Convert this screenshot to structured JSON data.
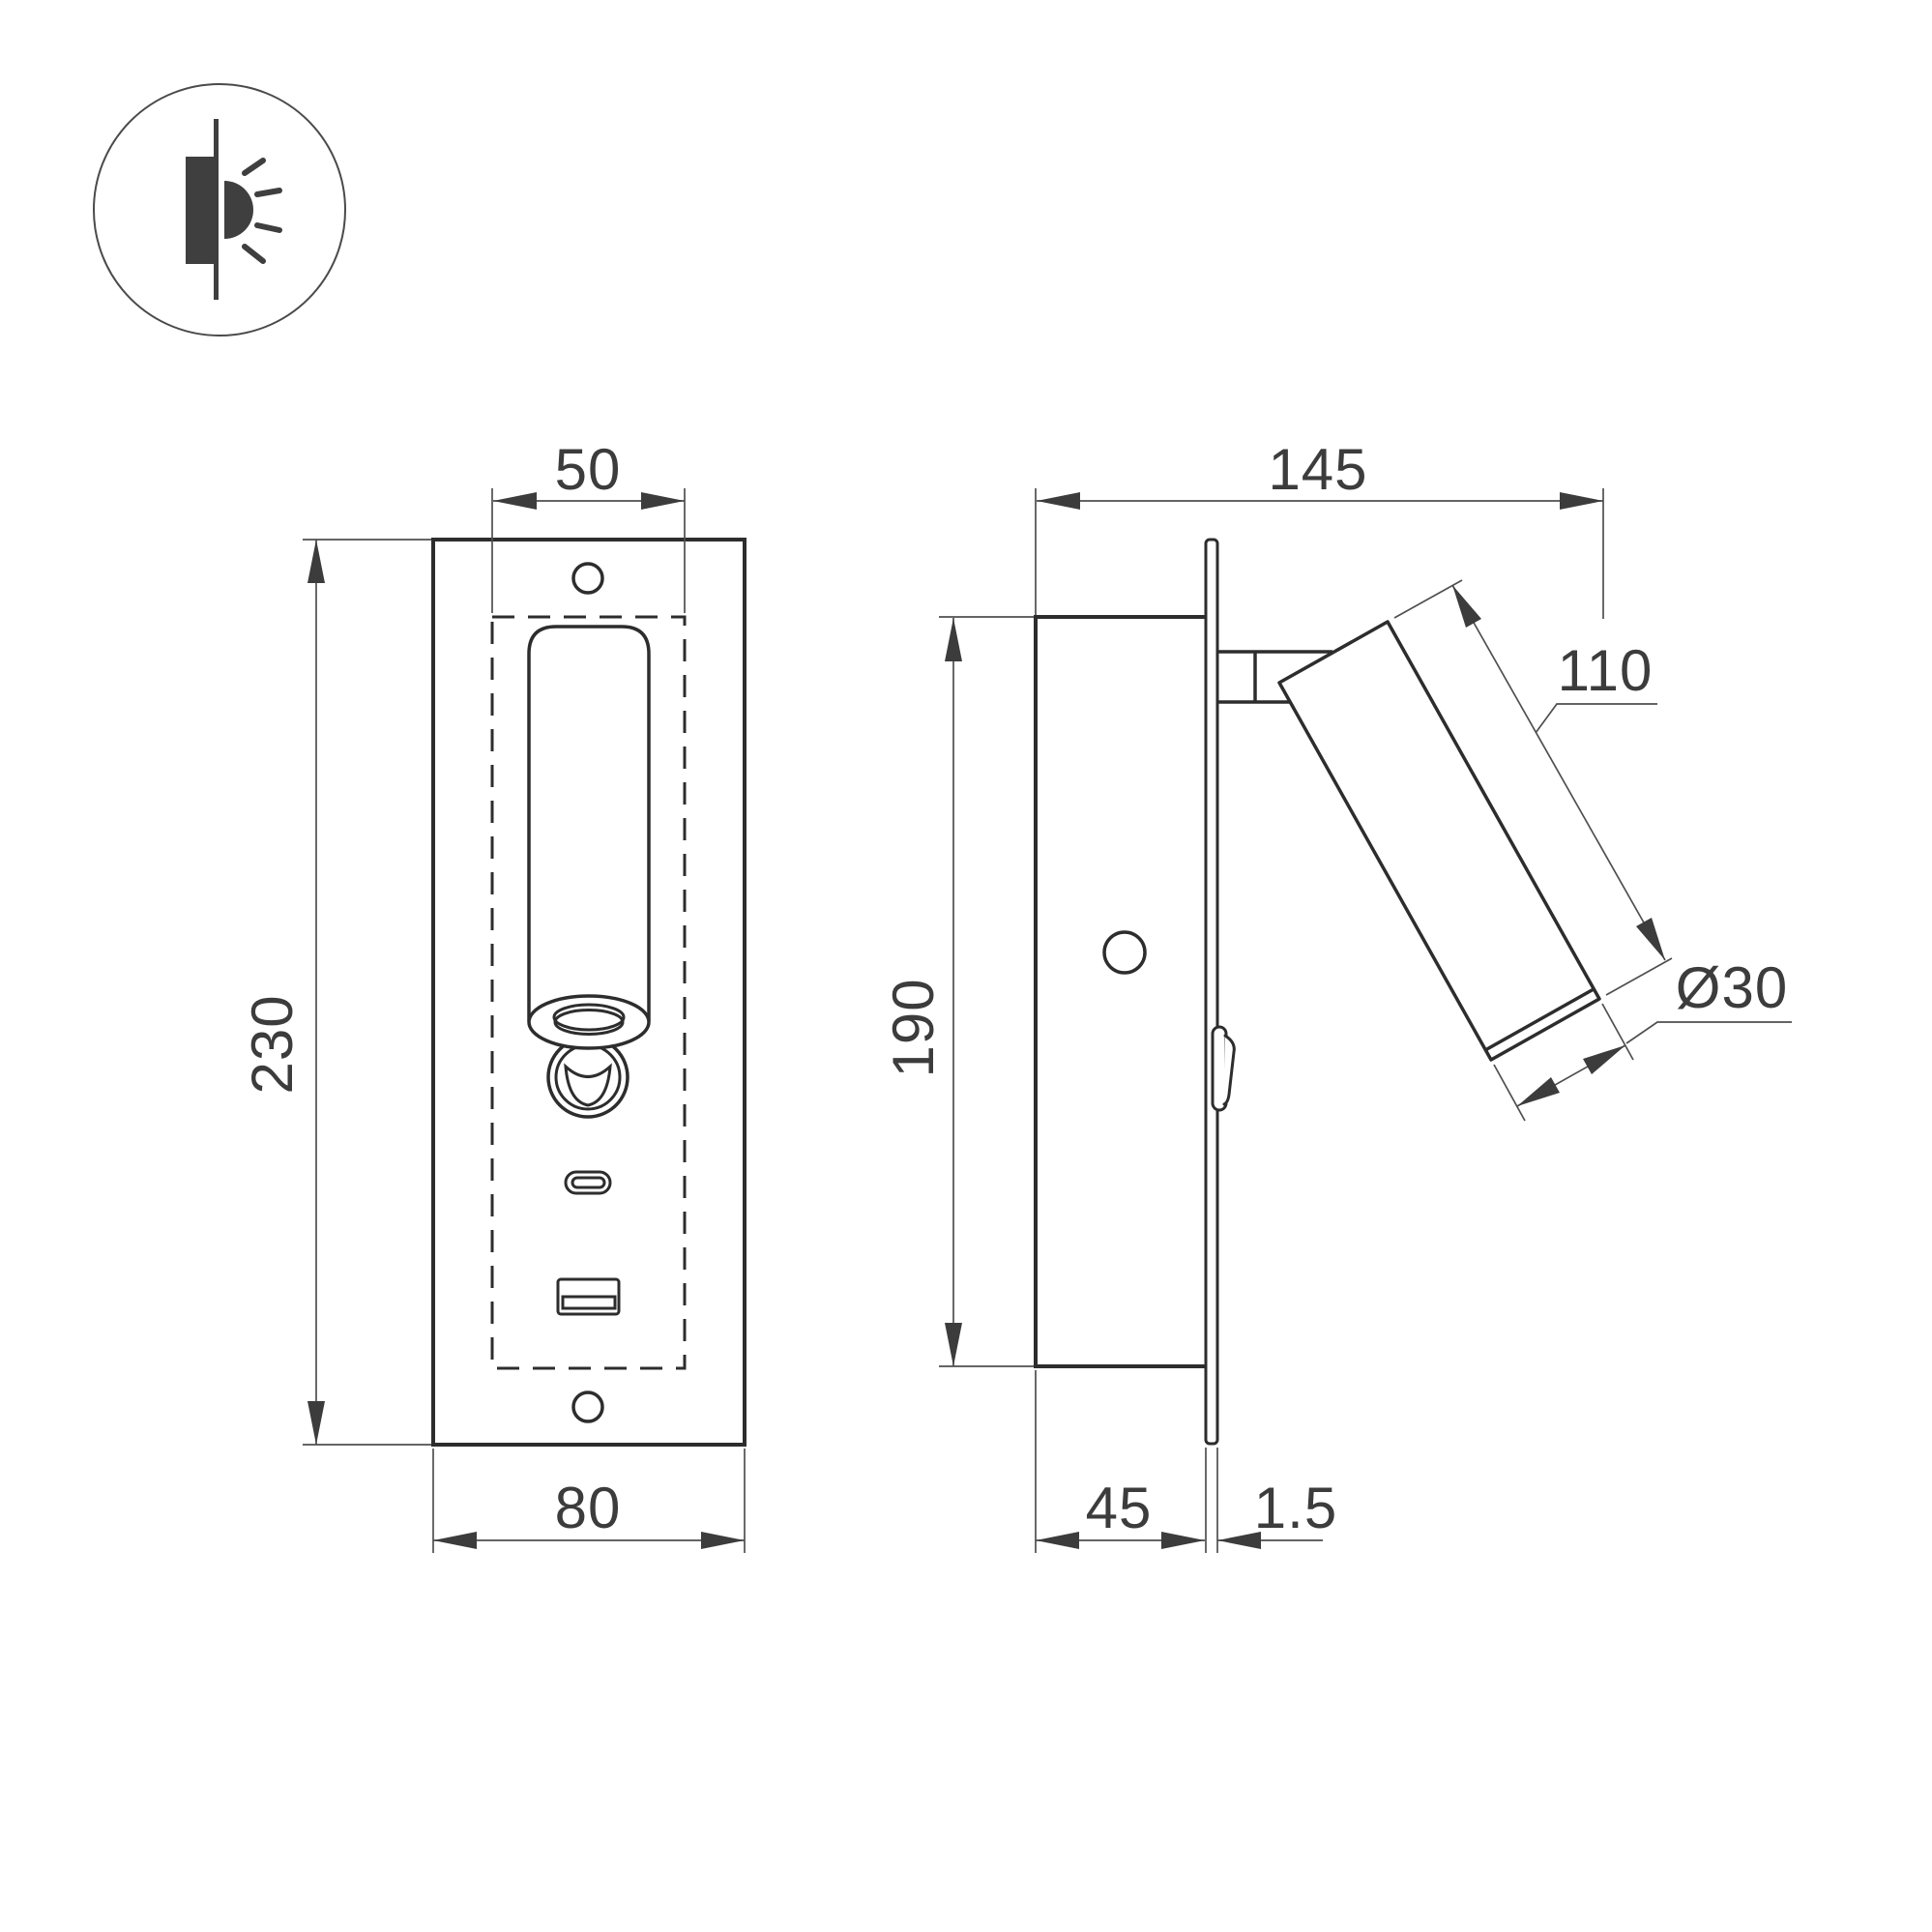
{
  "icon": {
    "meaning": "recessed-wall-light"
  },
  "labels": {
    "front": {
      "cutout_width": "50",
      "height": "230",
      "width": "80"
    },
    "side": {
      "total_depth": "145",
      "recess_height": "190",
      "lamp_length": "110",
      "lamp_diameter": "Ø30",
      "recess_depth": "45",
      "flange_thickness": "1.5"
    }
  },
  "colors": {
    "line": "#2d2d2d",
    "dimension": "#4f4f4f",
    "text": "#3c3c3c",
    "background": "#ffffff"
  }
}
